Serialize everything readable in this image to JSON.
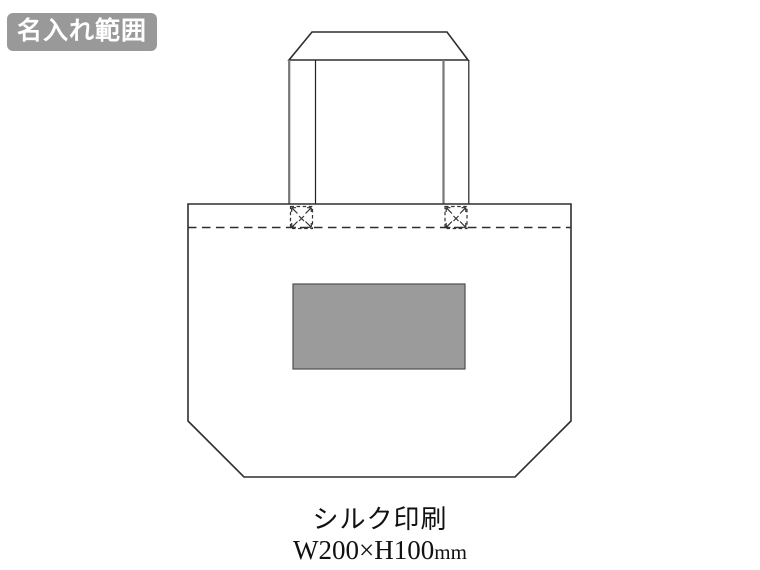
{
  "badge": {
    "label": "名入れ範囲",
    "bg_color": "#999999",
    "text_color": "#ffffff"
  },
  "diagram": {
    "subject": "tote-bag-front-view",
    "outline_color": "#2e2e2e",
    "seam_style": "dashed",
    "stitch_marks": "x-box-stitch-with-corner-arrows",
    "print_area": {
      "fill_color": "#9b9b9b",
      "border_color": "#4f4f4f"
    }
  },
  "caption": {
    "print_method": "シルク印刷",
    "print_size": "W200×H100",
    "print_size_unit": "mm"
  }
}
